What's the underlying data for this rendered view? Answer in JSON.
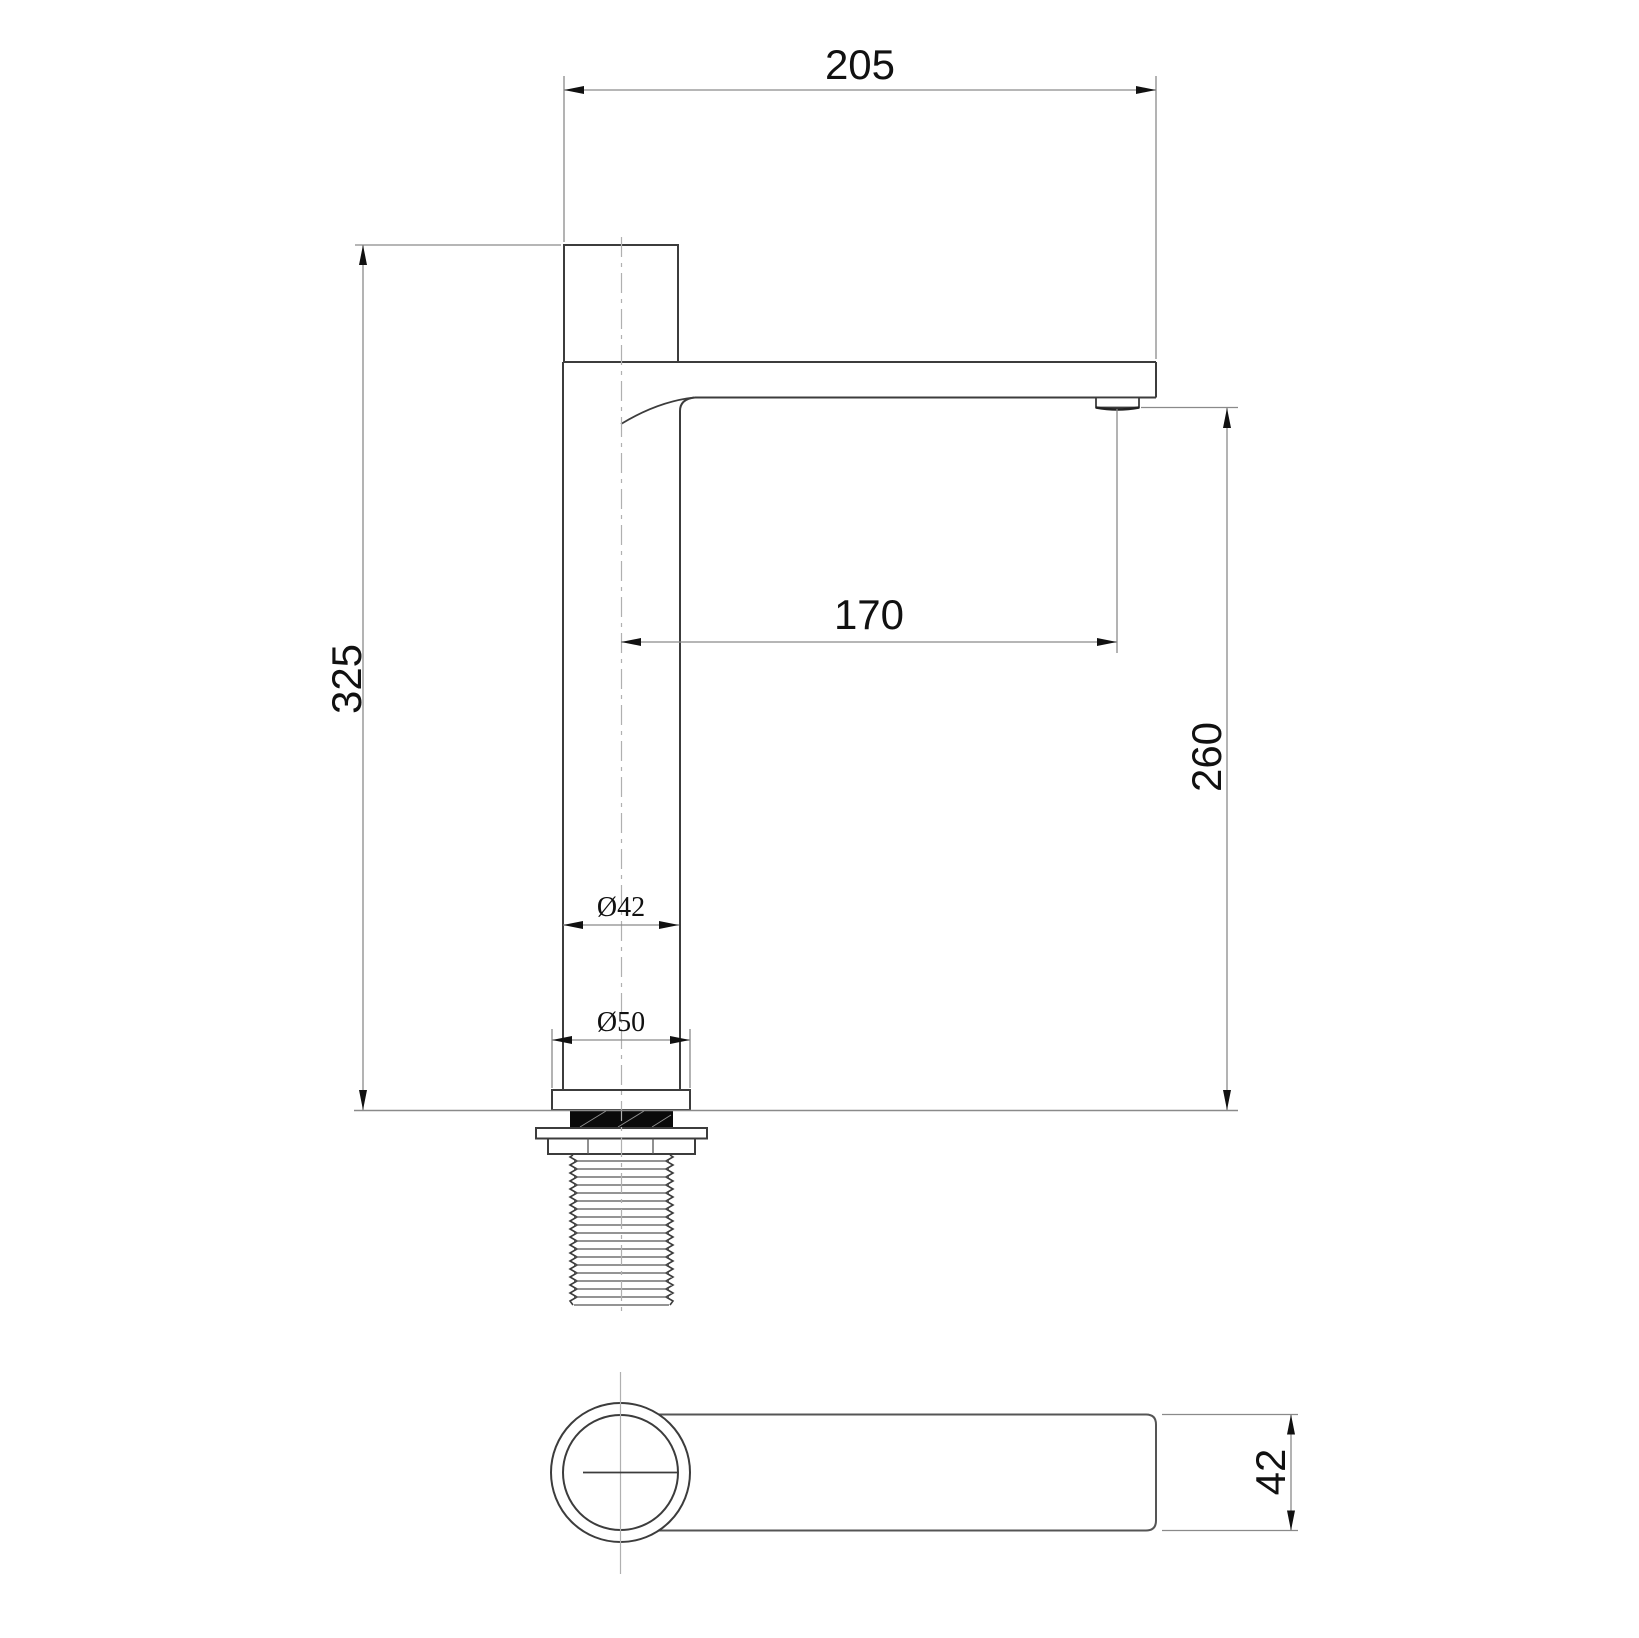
{
  "drawing": {
    "type": "technical-drawing",
    "subject": "tall single-lever basin faucet, side elevation and plan view",
    "background_color": "#ffffff",
    "object_line_color": "#3c3c3c",
    "dimension_line_color": "#8a8a8a",
    "text_color": "#111111",
    "gasket_fill_color": "#0a0a0a"
  },
  "dimensions": {
    "spout_overall_width": {
      "label": "205",
      "orientation": "horizontal"
    },
    "total_height": {
      "label": "325",
      "orientation": "vertical"
    },
    "outlet_offset": {
      "label": "170",
      "orientation": "horizontal"
    },
    "outlet_height": {
      "label": "260",
      "orientation": "vertical"
    },
    "body_diameter": {
      "label": "Ø42",
      "orientation": "horizontal"
    },
    "base_diameter": {
      "label": "Ø50",
      "orientation": "horizontal"
    },
    "spout_thickness": {
      "label": "42",
      "orientation": "vertical"
    }
  }
}
